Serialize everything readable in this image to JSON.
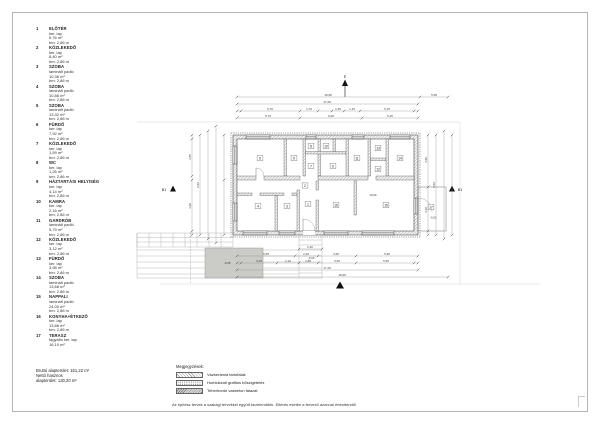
{
  "room_schedule": {
    "items": [
      {
        "no": "1",
        "name": "ELŐTÉR",
        "floor": "ker. lap",
        "area": "5,76 m²",
        "height": "bm: 2,86 m"
      },
      {
        "no": "2",
        "name": "KÖZLEKEDŐ",
        "floor": "ker. lap",
        "area": "8,40 m²",
        "height": "bm: 2,86 m"
      },
      {
        "no": "3",
        "name": "SZOBA",
        "floor": "laminált padló",
        "area": "10,36 m²",
        "height": "bm: 2,86 m"
      },
      {
        "no": "4",
        "name": "SZOBA",
        "floor": "laminált padló",
        "area": "10,86 m²",
        "height": "bm: 2,86 m"
      },
      {
        "no": "5",
        "name": "SZOBA",
        "floor": "laminált padló",
        "area": "13,32 m²",
        "height": "bm: 2,86 m"
      },
      {
        "no": "6",
        "name": "FÜRDŐ",
        "floor": "ker. lap",
        "area": "7,92 m²",
        "height": "bm: 2,86 m"
      },
      {
        "no": "7",
        "name": "KÖZLEKEDŐ",
        "floor": "ker. lap",
        "area": "1,59 m²",
        "height": "bm: 2,86 m"
      },
      {
        "no": "8",
        "name": "WC",
        "floor": "ker. lap",
        "area": "1,26 m²",
        "height": "bm: 2,86 m"
      },
      {
        "no": "9",
        "name": "HÁZTARTÁSI HELYISÉG",
        "floor": "ker. lap",
        "area": "4,14 m²",
        "height": "bm: 2,86 m"
      },
      {
        "no": "10",
        "name": "KAMRA",
        "floor": "ker. lap",
        "area": "2,16 m²",
        "height": "bm: 2,86 m"
      },
      {
        "no": "11",
        "name": "GARDRÓB",
        "floor": "laminált padló",
        "area": "5,79 m²",
        "height": "bm: 2,86 m"
      },
      {
        "no": "12",
        "name": "KÖZLEKEDŐ",
        "floor": "ker. lap",
        "area": "3,12 m²",
        "height": "bm: 2,86 m"
      },
      {
        "no": "13",
        "name": "FÜRDŐ",
        "floor": "ker. lap",
        "area": "3,98 m²",
        "height": "bm: 2,86 m"
      },
      {
        "no": "14",
        "name": "SZOBA",
        "floor": "laminált padló",
        "area": "13,68 m²",
        "height": "bm: 2,86 m"
      },
      {
        "no": "15",
        "name": "NAPPALI",
        "floor": "laminált padló",
        "area": "24,00 m²",
        "height": "bm: 2,86 m"
      },
      {
        "no": "16",
        "name": "KONYHA+ÉTKEZŐ",
        "floor": "ker. lap",
        "area": "13,86 m²",
        "height": "bm: 2,86 m"
      },
      {
        "no": "17",
        "name": "TERASZ",
        "floor": "fagyálló ker. lap",
        "area": "16,10 m²",
        "height": ""
      }
    ]
  },
  "totals": {
    "gross": "Bruttó alapterület: 161,22 m²",
    "net_line1": "Nettó hasznos",
    "net_line2": "alapterület: 130,20 m²"
  },
  "legend": {
    "title": "Megjegyzések:",
    "items": [
      {
        "label": "Vázkerámia tartófalak"
      },
      {
        "label": "Homlokzati grafitos hőszigetelés"
      },
      {
        "label": "Teherhordó vasbeton falazat"
      }
    ]
  },
  "footer": {
    "note": "Az építész tervek a szakági tervekkel együtt kezelendőek. Eltérés esetén a tervező azonnal értesítendő!"
  },
  "plan": {
    "north_label": "É",
    "section_marker": "B1",
    "room_numbers": [
      "1",
      "2",
      "3",
      "4",
      "5",
      "6",
      "7",
      "8",
      "9",
      "10",
      "11",
      "12",
      "13",
      "14",
      "15",
      "16",
      "17"
    ],
    "levels": {
      "main": "±0,00",
      "terrace": "-0,02",
      "porch": "-0,02",
      "pad": "-0,05"
    },
    "dims": {
      "top": [
        "18,98",
        "5,58",
        "17,28",
        "5,70",
        "1,70",
        "1,35",
        "1,15",
        "5,15",
        "5,70",
        "6,00",
        "5,25"
      ],
      "bottom": [
        "2,20",
        "5,55",
        "2,20",
        "3,65",
        "5,90",
        "3,45",
        "2,10",
        "1,80",
        "3,60",
        "5,55",
        "17,28",
        "18,98"
      ],
      "left": [
        "3,55",
        "4,90",
        "9,56"
      ],
      "right": [
        "4,95",
        "4,20",
        "9,56"
      ]
    }
  }
}
